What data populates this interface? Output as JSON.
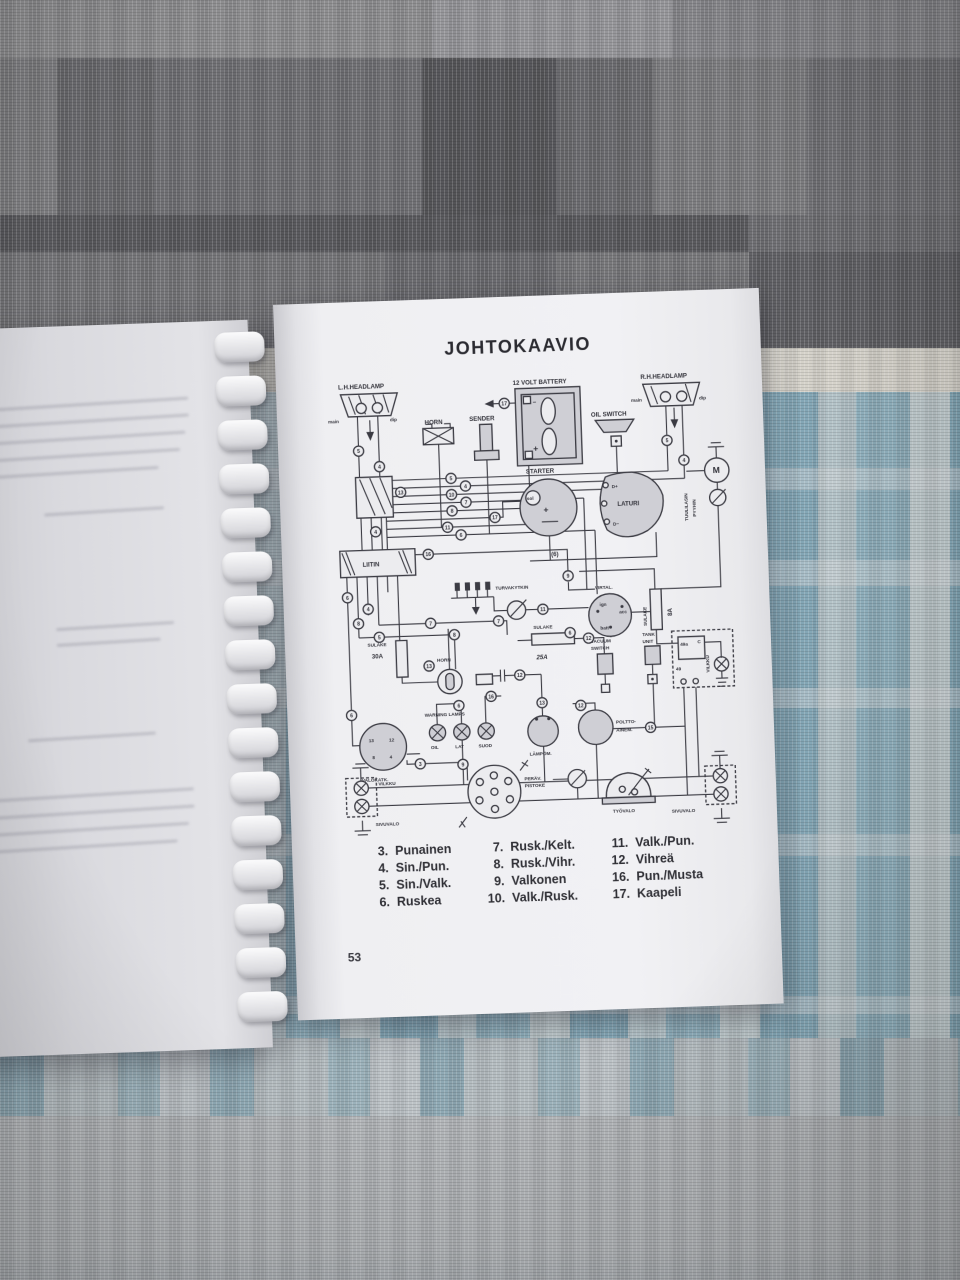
{
  "page": {
    "title": "JOHTOKAAVIO",
    "page_number": "53"
  },
  "diagram": {
    "components": {
      "lh_headlamp": "L.H.HEADLAMP",
      "rh_headlamp": "R.H.HEADLAMP",
      "main": "main",
      "dip": "dip",
      "horn": "HORN",
      "sender": "SENDER",
      "battery": "12 VOLT BATTERY",
      "minus": "−",
      "plus": "+",
      "oil_switch": "OIL SWITCH",
      "motor": "M",
      "wiper1": "TUULILASIN",
      "wiper2": "PYYHIN",
      "starter": "STARTER",
      "sol": "sol",
      "laturi": "LATURI",
      "d_plus": "D+",
      "d_minus": "D−",
      "six": "(6)",
      "liitin": "LIITIN",
      "turvakytkin": "TURVAKYTKIN",
      "virtal": "VIRTAL.",
      "ign": "ign",
      "acc": "acc",
      "batt": "batt",
      "sulake": "SULAKE",
      "amp8": "8A",
      "amp25": "25A",
      "amp30": "30A",
      "vacuum1": "VACUUM",
      "vacuum2": "SWITCH",
      "tank1": "TANK",
      "tank2": "UNIT",
      "t49a": "49a",
      "tc": "C",
      "t49": "49",
      "vilkku": "VILKKU",
      "warning_lamps": "WARNING LAMPS",
      "oil": "OIL",
      "lat": "LAT",
      "suod": "SUOD",
      "lampom": "LÄMPÖM.",
      "poltto1": "POLTTO-",
      "poltto2": "AINEM.",
      "valokatk": "VALOKATK.",
      "v13": "13",
      "v12": "12",
      "v8": "8",
      "v4": "4",
      "perav1": "PERÄV.",
      "perav2": "PISTOKE",
      "tyovalo": "TYÖVALO",
      "sivuvalo": "SIVUVALO"
    },
    "junctions": {
      "j1": "5",
      "j2": "4",
      "j3": "5",
      "j4": "4",
      "j5": "10",
      "j6": "7",
      "j7": "8",
      "j8": "17",
      "j9": "11",
      "j10": "6",
      "j11": "5",
      "j12": "4",
      "j13": "17",
      "j14": "13",
      "j15": "4",
      "j16": "16",
      "j17": "6",
      "j18": "8",
      "j19": "4",
      "j20": "5",
      "j21": "6",
      "j22": "9",
      "j23": "11",
      "j24": "7",
      "j25": "8",
      "j26": "7",
      "j27": "6",
      "j28": "12",
      "j29": "13",
      "j30": "12",
      "j31": "16",
      "j32": "6",
      "j33": "13",
      "j34": "12",
      "j35": "9",
      "j36": "15",
      "j37": "3"
    }
  },
  "legend": {
    "col1": [
      [
        "3.",
        "Punainen"
      ],
      [
        "4.",
        "Sin./Pun."
      ],
      [
        "5.",
        "Sin./Valk."
      ],
      [
        "6.",
        "Ruskea"
      ]
    ],
    "col2": [
      [
        "7.",
        "Rusk./Kelt."
      ],
      [
        "8.",
        "Rusk./Vihr."
      ],
      [
        "9.",
        "Valkonen"
      ],
      [
        "10.",
        "Valk./Rusk."
      ]
    ],
    "col3": [
      [
        "11.",
        "Valk./Pun."
      ],
      [
        "12.",
        "Vihreä"
      ],
      [
        "16.",
        "Pun./Musta"
      ],
      [
        "17.",
        "Kaapeli"
      ]
    ]
  }
}
